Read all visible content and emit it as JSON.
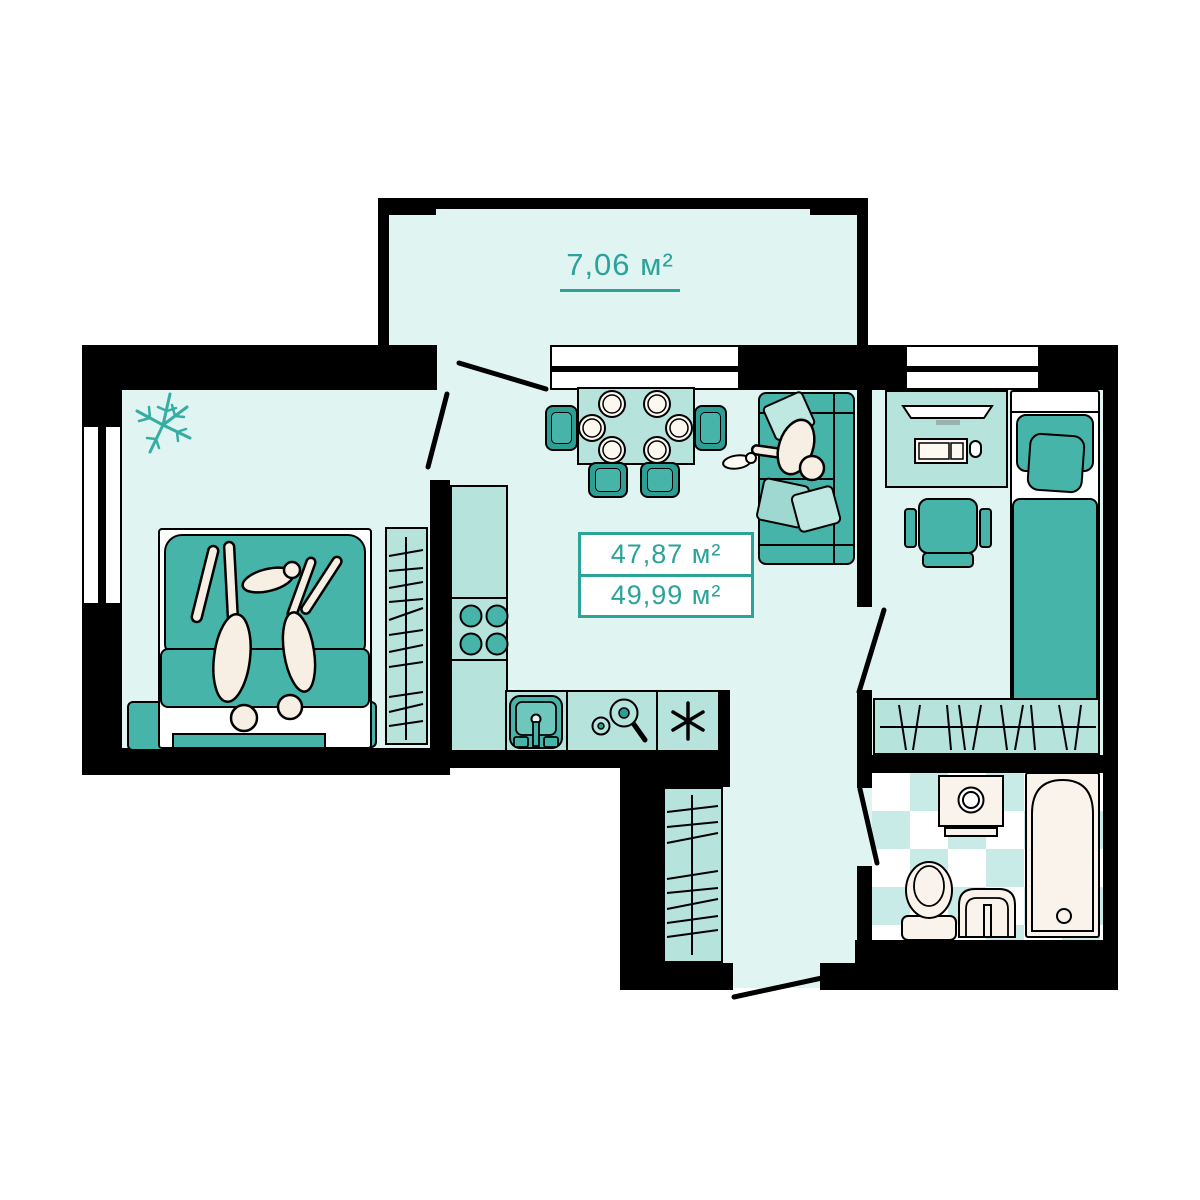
{
  "floor_plan": {
    "balcony": {
      "area_label": "7,06 м²"
    },
    "area_summary": {
      "living_area": "47,87 м²",
      "total_area": "49,99 м²"
    },
    "colors": {
      "wall": "#000000",
      "floor": "#e0f4f2",
      "furniture_light": "#b7e3dd",
      "furniture_teal": "#47b4aa",
      "furniture_teal_dark": "#2d9e94",
      "accent_text": "#2aa399",
      "fixture_cream": "#f9f3ec",
      "tile_checker": "#c9ebe7"
    },
    "icons": {
      "counter_symbol": "asterisk-6-spoke",
      "plant": "fern-sprig",
      "stove": "four-burners",
      "kitchen_sink": "sink-with-faucet",
      "cookware": "pan-and-pot"
    }
  }
}
